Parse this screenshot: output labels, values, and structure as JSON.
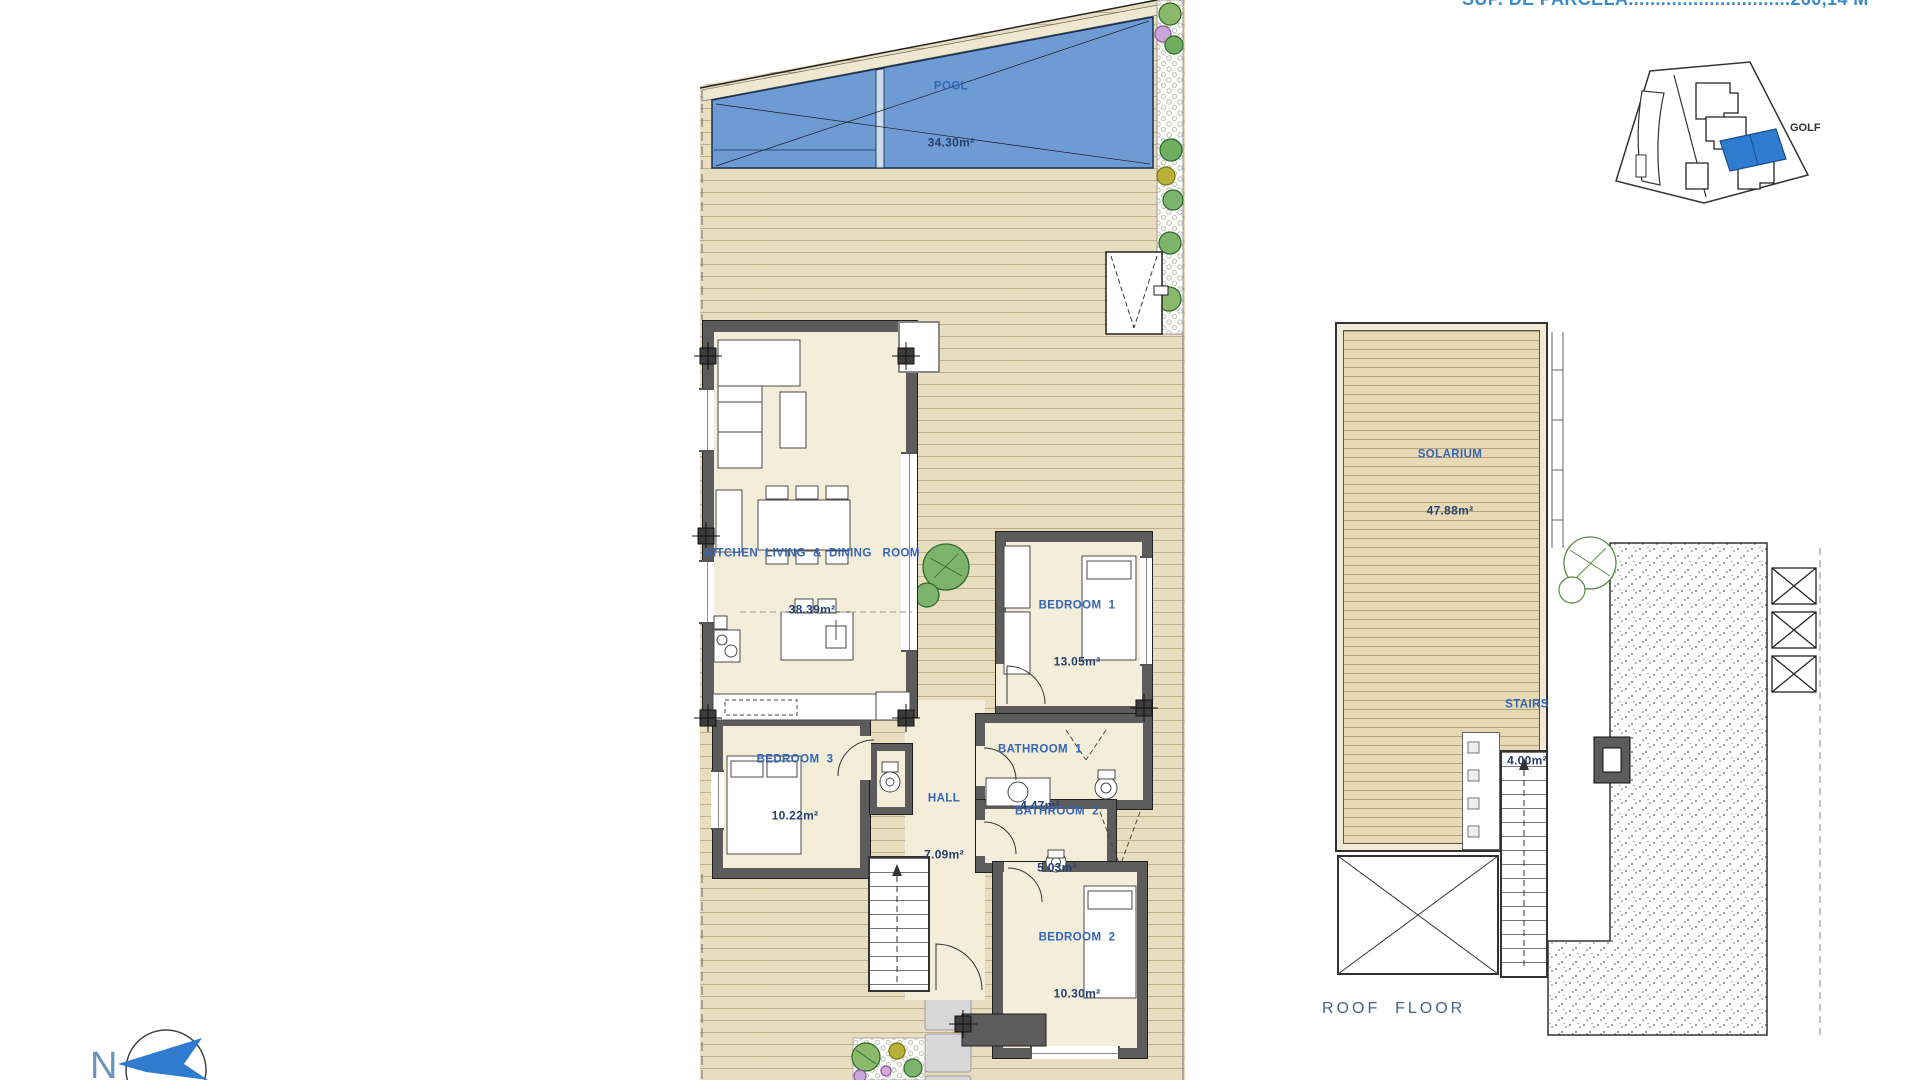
{
  "header": {
    "parcel_area_line": "SUP. DE PARCELA..............................260,14 M²"
  },
  "ground_floor": {
    "pool": {
      "name": "POOL",
      "area": "34.30m²"
    },
    "rooms": {
      "kitchen_living": {
        "name": "KITCHEN  LIVING  &  DINING   ROOM",
        "area": "38.39m²"
      },
      "bedroom1": {
        "name": "BEDROOM  1",
        "area": "13.05m²"
      },
      "bedroom3": {
        "name": "BEDROOM  3",
        "area": "10.22m²"
      },
      "bathroom1": {
        "name": "BATHROOM  1",
        "area": "4.47m²"
      },
      "hall": {
        "name": "HALL",
        "area": "7.09m²"
      },
      "bathroom2": {
        "name": "BATHROOM  2",
        "area": "5.03m²"
      },
      "bedroom2": {
        "name": "BEDROOM  2",
        "area": "10.30m²"
      }
    }
  },
  "roof_floor": {
    "title": "ROOF  FLOOR",
    "rooms": {
      "solarium": {
        "name": "SOLARIUM",
        "area": "47.88m²"
      },
      "stairs": {
        "name": "STAIRS",
        "area": "4.00m²"
      }
    }
  },
  "site_map": {
    "golf_label": "GOLF"
  },
  "compass": {
    "north_label": "N"
  },
  "colors": {
    "room_label_blue": "#3565b5",
    "area_value_navy": "#27406e",
    "pool_blue": "#6f9bd4",
    "deck_tan": "#e9ddbf",
    "wall_gray": "#5c5c5c",
    "roof_title_blue": "#49618c",
    "parcel_text_blue": "#3e8ac6",
    "site_highlight_blue": "#2e7bd0"
  }
}
